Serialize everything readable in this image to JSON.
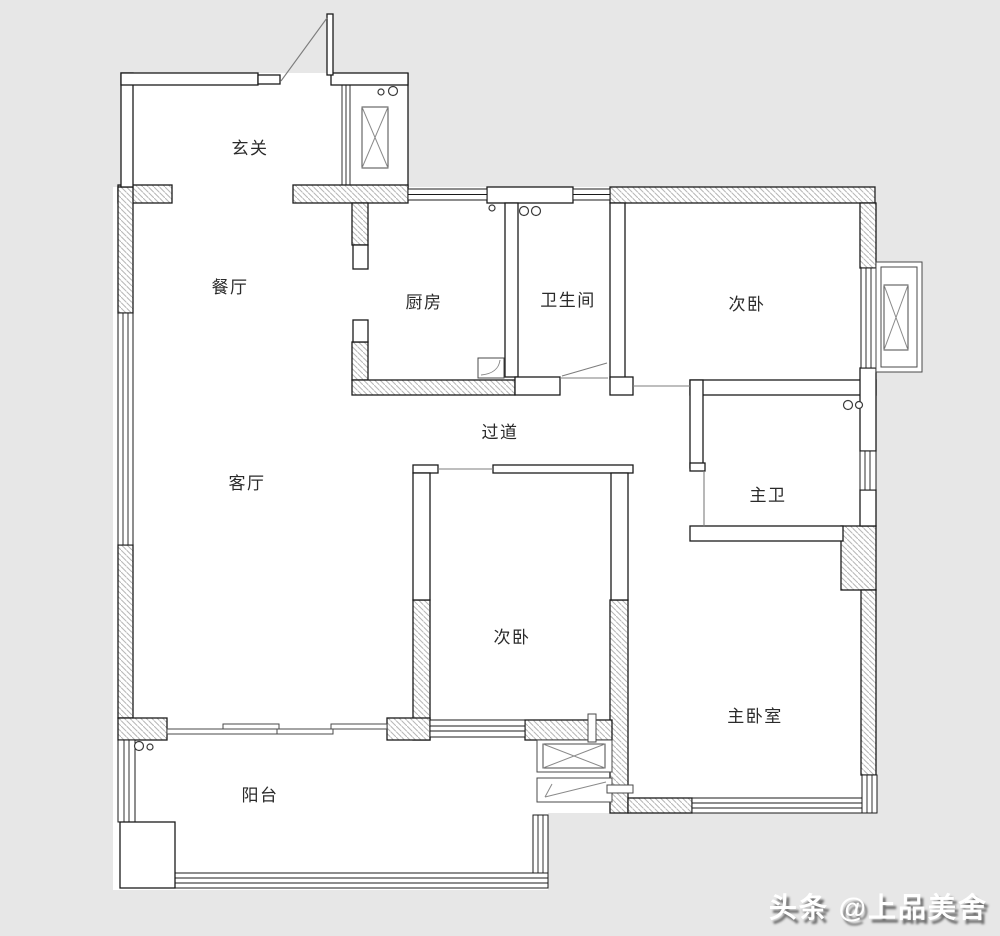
{
  "plan": {
    "rooms": [
      {
        "id": "entrance",
        "label": "玄关"
      },
      {
        "id": "dining",
        "label": "餐厅"
      },
      {
        "id": "kitchen",
        "label": "厨房"
      },
      {
        "id": "bathroom",
        "label": "卫生间"
      },
      {
        "id": "bedroom-top",
        "label": "次卧"
      },
      {
        "id": "hallway",
        "label": "过道"
      },
      {
        "id": "living",
        "label": "客厅"
      },
      {
        "id": "master-bath",
        "label": "主卫"
      },
      {
        "id": "bedroom-middle",
        "label": "次卧"
      },
      {
        "id": "master-bedroom",
        "label": "主卧室"
      },
      {
        "id": "balcony",
        "label": "阳台"
      }
    ],
    "colors": {
      "background": "#e7e7e7",
      "floor": "#ffffff",
      "wall_outline": "#1b1b1b",
      "hatch_line": "#b6b6b6",
      "label_text": "#2a2a2a"
    }
  },
  "watermark": {
    "text": "头条 @上品美舍"
  }
}
